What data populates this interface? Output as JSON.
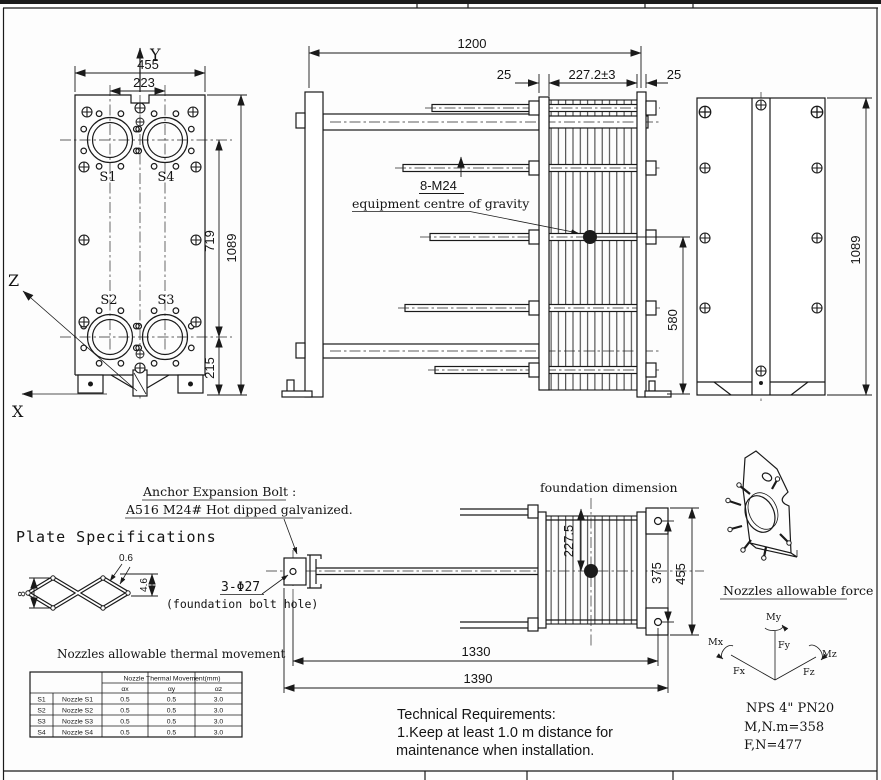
{
  "front_view": {
    "axis_x": "X",
    "axis_y": "Y",
    "axis_z": "Z",
    "dim_overall_width": "455",
    "dim_nozzle_spacing_h": "223",
    "dim_nozzle_spacing_v": "719",
    "dim_overall_height": "1089",
    "dim_bottom_nozzle": "215",
    "nozzle_s1": "S1",
    "nozzle_s2": "S2",
    "nozzle_s3": "S3",
    "nozzle_s4": "S4"
  },
  "side_view": {
    "dim_overall_length": "1200",
    "dim_gap_left": "25",
    "dim_plate_pack": "227.2±3",
    "dim_gap_right": "25",
    "tie_bolt_label": "8-M24",
    "cog_label": "equipment centre of gravity",
    "dim_cog_height": "580"
  },
  "rear_view": {
    "dim_overall_height": "1089"
  },
  "foundation_view": {
    "title": "foundation dimension",
    "anchor_note_1": "Anchor Expansion Bolt :",
    "anchor_note_2": "A516 M24# Hot dipped galvanized.",
    "bolt_hole_qty": "3-Φ27",
    "bolt_hole_note": "(foundation bolt hole)",
    "dim_pack_to_centre": "227.5",
    "dim_hole_spacing": "375",
    "dim_plate_width": "455",
    "dim_anchor_to_hole": "1330",
    "dim_overall": "1390"
  },
  "plate_spec": {
    "title": "Plate Specifications",
    "dim_thickness": "0.6",
    "dim_depth": "4.6",
    "dim_height": "8"
  },
  "movement_table": {
    "title": "Nozzles allowable thermal movement",
    "span_header": "Nozzle Thermal Movement(mm)",
    "col_ax": "αx",
    "col_ay": "αy",
    "col_az": "αz",
    "rows": [
      {
        "id": "S1",
        "name": "Nozzle S1",
        "ax": "0.5",
        "ay": "0.5",
        "az": "3.0"
      },
      {
        "id": "S2",
        "name": "Nozzle S2",
        "ax": "0.5",
        "ay": "0.5",
        "az": "3.0"
      },
      {
        "id": "S3",
        "name": "Nozzle S3",
        "ax": "0.5",
        "ay": "0.5",
        "az": "3.0"
      },
      {
        "id": "S4",
        "name": "Nozzle S4",
        "ax": "0.5",
        "ay": "0.5",
        "az": "3.0"
      }
    ]
  },
  "nozzle_force": {
    "title": "Nozzles allowable force",
    "label_my": "My",
    "label_fy": "Fy",
    "label_mx": "Mx",
    "label_fx": "Fx",
    "label_mz": "Mz",
    "label_fz": "Fz",
    "spec_size": "NPS 4\" PN20",
    "spec_moment": "M,N.m=358",
    "spec_force": "F,N=477"
  },
  "technical_requirements": {
    "title": "Technical Requirements:",
    "line1": "1.Keep at least 1.0 m distance for",
    "line2": "maintenance when installation."
  }
}
